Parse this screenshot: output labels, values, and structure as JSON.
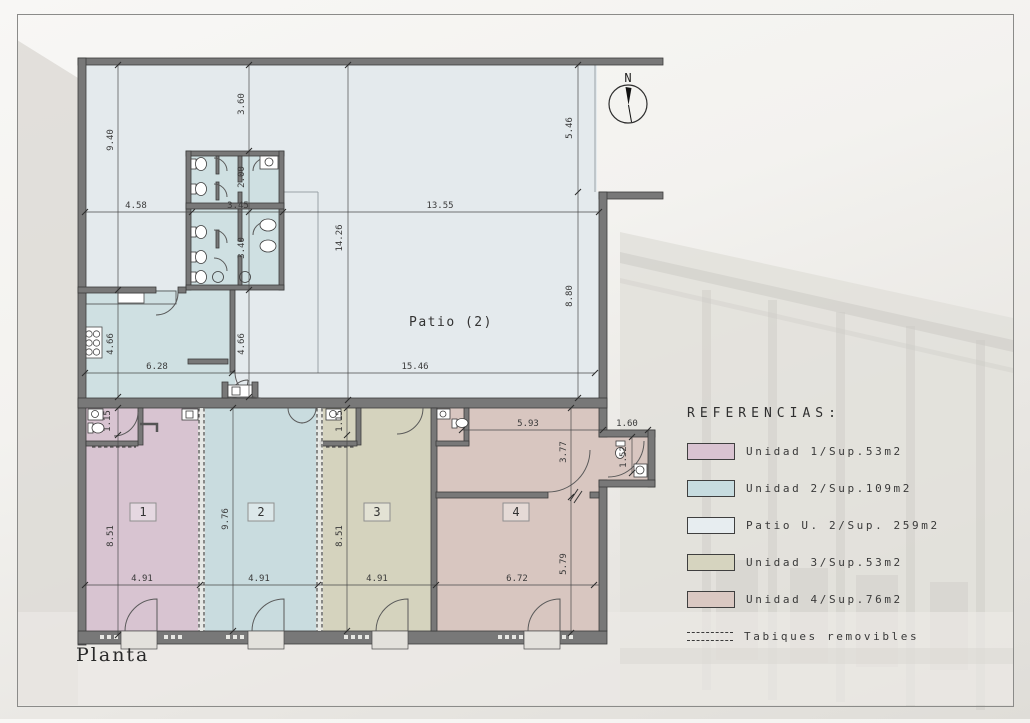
{
  "title": "Planta",
  "compass": {
    "label": "N"
  },
  "plan": {
    "patio_label": "Patio (2)",
    "rooms": {
      "r1": "1",
      "r2": "2",
      "r3": "3",
      "r4": "4"
    },
    "dims": {
      "v3_60": "3.60",
      "v9_40": "9.40",
      "v5_46": "5.46",
      "v4_58": "4.58",
      "v2_00": "2.00",
      "v3_45": "3.45",
      "v3_40": "3.40",
      "v13_55": "13.55",
      "v14_26": "14.26",
      "v8_80": "8.80",
      "v4_66_left": "4.66",
      "v4_66_right": "4.66",
      "v6_28": "6.28",
      "v15_46": "15.46",
      "v1_15_u1": "1.15",
      "v8_51_u1": "8.51",
      "v9_76": "9.76",
      "v1_15_u3": "1.15",
      "v8_51_u3": "8.51",
      "v4_91_u1": "4.91",
      "v4_91_u2": "4.91",
      "v4_91_u3": "4.91",
      "v6_72": "6.72",
      "v5_93": "5.93",
      "v1_60": "1.60",
      "v3_77": "3.77",
      "v1_52": "1.52",
      "v5_79": "5.79"
    }
  },
  "legend": {
    "title": "REFERENCIAS:",
    "items": [
      {
        "label": "Unidad 1/Sup.53m2",
        "color": "#d9c3d1"
      },
      {
        "label": "Unidad 2/Sup.109m2",
        "color": "#c7dce0"
      },
      {
        "label": "Patio U. 2/Sup. 259m2",
        "color": "#e7edf0"
      },
      {
        "label": "Unidad 3/Sup.53m2",
        "color": "#d6d4bf"
      },
      {
        "label": "Unidad 4/Sup.76m2",
        "color": "#dac8c2"
      },
      {
        "label": "Tabiques removibles",
        "color": "dashed"
      }
    ]
  },
  "colors": {
    "wall": "#787878",
    "patio": "#e4eaed",
    "unit1": "#d8c4d1",
    "unit2": "#c9dcdf",
    "unit2_service": "#cfe0e2",
    "unit3": "#d5d3be",
    "unit4": "#d8c6c0"
  }
}
